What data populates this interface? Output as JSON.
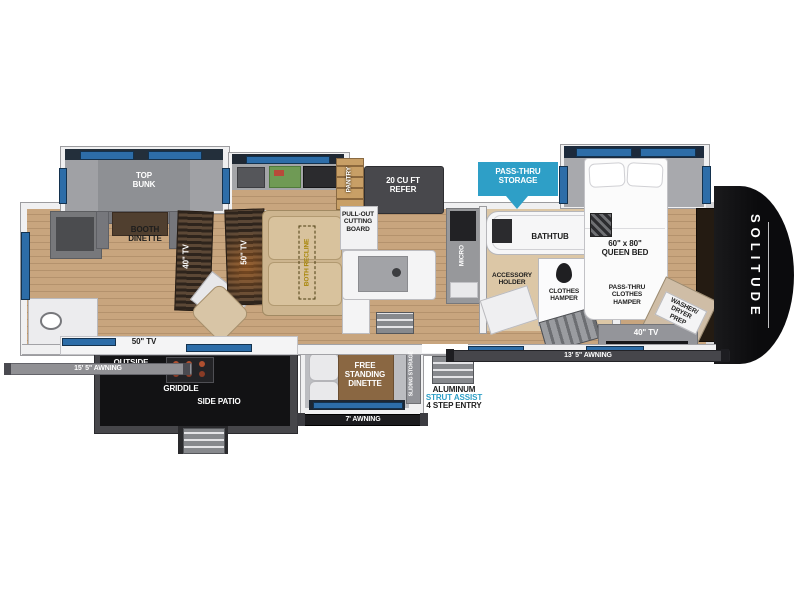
{
  "floorplan": {
    "brand": "SOLITUDE",
    "labels": {
      "top_bunk": "TOP\nBUNK",
      "booth_dinette": "BOOTH\nDINETTE",
      "tv40_wall": "40\" TV",
      "tv50_wall": "50\" TV",
      "both_recline": "BOTH RECLINE",
      "pantry": "PANTRY",
      "refer": "20 CU FT\nREFER",
      "cutting_board": "PULL-OUT\nCUTTING\nBOARD",
      "pass_thru_storage": "PASS-THRU\nSTORAGE",
      "micro": "MICRO",
      "bathtub": "BATHTUB",
      "accessory_holder": "ACCESSORY\nHOLDER",
      "clothes_hamper": "CLOTHES\nHAMPER",
      "pass_thru_clothes_hamper": "PASS-THRU\nCLOTHES\nHAMPER",
      "queen_bed": "60\" x 80\"\nQUEEN BED",
      "washer_dryer_prep": "WASHER/\nDRYER\nPREP",
      "tv40_bedroom": "40\" TV",
      "tv50_outside": "50\" TV",
      "outside_kitchen": "OUTSIDE\nKITCHEN",
      "griddle": "GRIDDLE",
      "side_patio": "SIDE PATIO",
      "free_standing_dinette": "FREE\nSTANDING\nDINETTE",
      "sliding_storage": "SLIDING STORAGE",
      "awning_left": "15' 5\" AWNING",
      "awning_door": "7' AWNING",
      "awning_right": "13' 5\" AWNING",
      "entry_material": "ALUMINUM",
      "entry_strut": "STRUT ASSIST",
      "entry_steps": "4 STEP ENTRY"
    },
    "colors": {
      "accent_cyan": "#2E9FC7",
      "window_blue": "#2D6DA8",
      "floor_wood": "#C8A57E",
      "patio_black": "#131315",
      "cap_black": "#0D0D0D"
    }
  }
}
